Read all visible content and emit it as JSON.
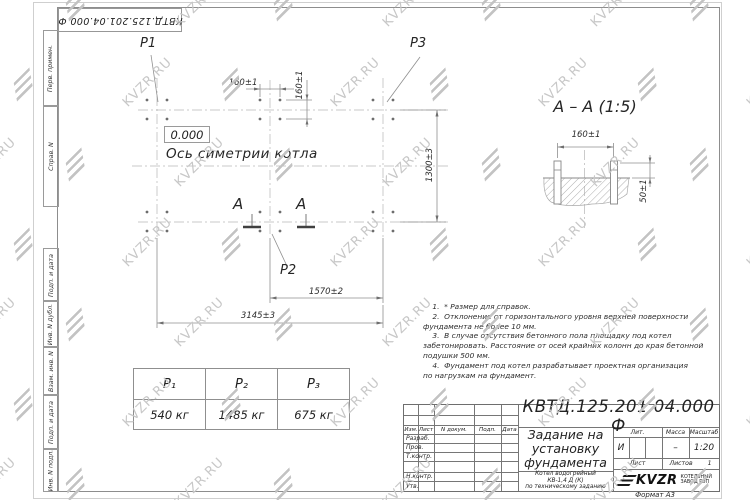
{
  "watermark": {
    "text": "KVZR.RU",
    "grid": {
      "cols": 8,
      "rows": 7,
      "dx": 104,
      "dy": 80,
      "x0": -40,
      "y0": -5,
      "stagger": 52
    }
  },
  "stamp_top": {
    "doc_number": "КВТД.125.201.04.000  Ф"
  },
  "margin_labels": [
    "Перв. примен.",
    "Справ. N",
    "Подп. и дата",
    "Инв. N дубл.",
    "Взам. инв. N",
    "Подп. и дата",
    "Инв. N подл."
  ],
  "plan": {
    "labels": {
      "p1": "P1",
      "p2": "P2",
      "p3": "P3",
      "level": "0.000",
      "axis": "Ось симетрии котла",
      "section_a_left": "А",
      "section_a_right": "А"
    },
    "dims": {
      "d160h": "160±1",
      "d160v": "160±1",
      "d1300": "1300±3",
      "d1570": "1570±2",
      "d3145": "3145±3"
    }
  },
  "section_view": {
    "title": "А – А (1:5)",
    "dims": {
      "d160": "160±1",
      "d50": "50±1"
    }
  },
  "load_table": {
    "headers": [
      "P₁",
      "P₂",
      "P₃"
    ],
    "values": [
      "540  кг",
      "1485  кг",
      "675  кг"
    ]
  },
  "notes": [
    "    1.  * Размер для справок.",
    "    2.  Отклонение от горизонтального уровня верхней поверхности",
    "фундамента не более 10 мм.",
    "    3.  В случае отсутствия бетонного пола площадку под котел",
    "забетонировать. Расстояние от осей крайних колонн до края бетонной",
    "подушки 500 мм.",
    "    4.  Фундамент под котел разрабатывает проектная организация",
    "по нагрузкам на фундамент."
  ],
  "title_block": {
    "doc_number": "КВТД.125.201.04.000  Ф",
    "title_lines": [
      "Задание на",
      "установку",
      "фундамента"
    ],
    "subtitle_lines": [
      "Котел водогрейный",
      "КВ-1,4  Д (К)",
      "по техническому заданию"
    ],
    "rev_header": [
      "Изм.",
      "Лист",
      "N докум.",
      "Подп.",
      "Дата"
    ],
    "sign_labels": [
      "Разраб.",
      "Пров.",
      "Т.контр.",
      "Н.контр.",
      "Утв."
    ],
    "lit_label": "Лит.",
    "mass_label": "Масса",
    "scale_label": "Масштаб",
    "lit_value": "И",
    "mass_value": "–",
    "scale_value": "1:20",
    "sheet_label": "Лист",
    "sheets_label": "Листов",
    "sheets_value": "1",
    "logo": {
      "brand": "KVZR",
      "sub_lines": [
        "КОТЕЛЬНЫЙ",
        "ЗАВОД РЭП"
      ]
    },
    "format_label": "Формат А3"
  }
}
